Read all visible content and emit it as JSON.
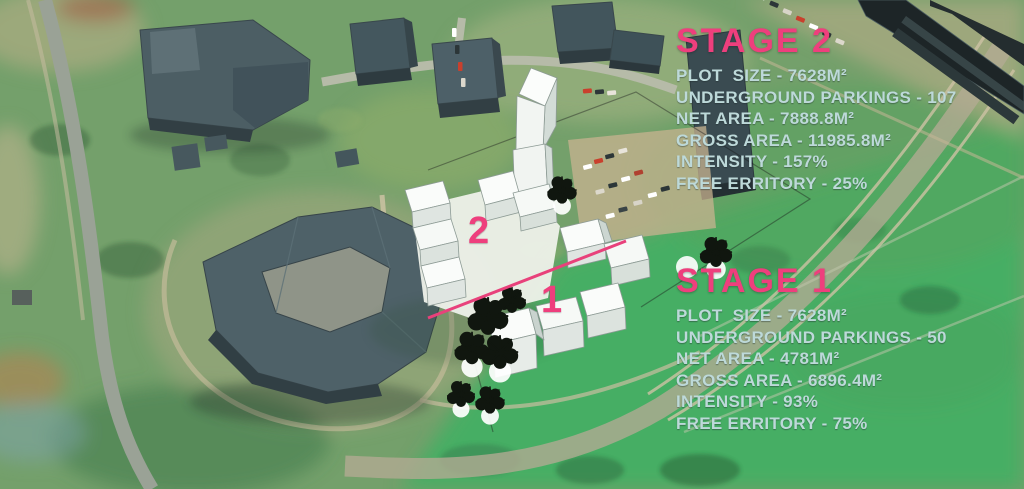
{
  "stage2": {
    "title": "STAGE 2",
    "stats": [
      "PLOT  SIZE - 7628M²",
      "UNDERGROUND PARKINGS - 107",
      "NET AREA - 7888.8M²",
      "GROSS AREA - 11985.8M²",
      "INTENSITY - 157%",
      "FREE ERRITORY - 25%"
    ]
  },
  "stage1": {
    "title": "STAGE 1",
    "stats": [
      "PLOT  SIZE - 7628M²",
      "UNDERGROUND PARKINGS - 50",
      "NET AREA - 4781M²",
      "GROSS AREA - 6896.4M²",
      "INTENSITY - 93%",
      "FREE ERRITORY - 75%"
    ]
  },
  "markers": {
    "stage2": "2",
    "stage1": "1"
  },
  "colors": {
    "pink": "#ee3f7d",
    "stat": "#bdd9d9"
  }
}
